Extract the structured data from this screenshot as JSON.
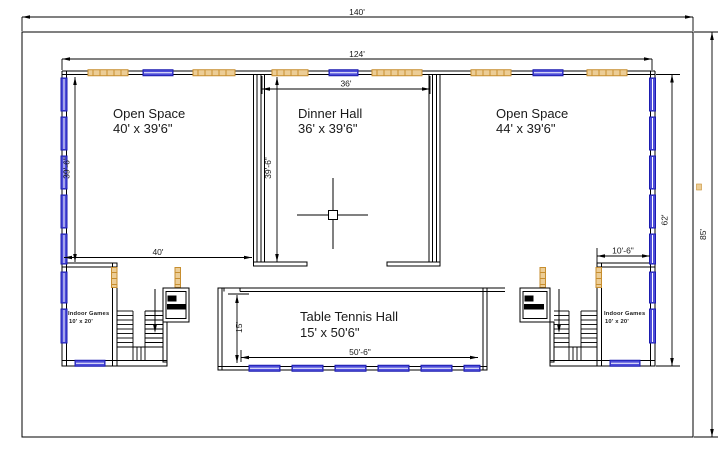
{
  "rooms": {
    "open_space_left": {
      "name": "Open Space",
      "size": "40' x 39'6\""
    },
    "dinner_hall": {
      "name": "Dinner Hall",
      "size": "36' x 39'6\""
    },
    "open_space_right": {
      "name": "Open Space",
      "size": "44' x 39'6\""
    },
    "table_tennis": {
      "name": "Table Tennis Hall",
      "size": "15' x 50'6\""
    },
    "indoor_games_left": {
      "name": "Indoor Games",
      "size": "10' x 20'"
    },
    "indoor_games_right": {
      "name": "Indoor Games",
      "size": "10' x 20'"
    }
  },
  "dimensions": {
    "overall_width": "140'",
    "inner_width": "124'",
    "dinner_width": "36'",
    "open_left_width": "40'",
    "open_left_height": "39'-6\"",
    "dinner_height": "39'-6\"",
    "inner_height": "62'",
    "overall_height": "85'",
    "tt_width": "50'-6\"",
    "tt_height": "15'",
    "indoor_right_width": "10'-6\""
  },
  "colors": {
    "window_blue": "#4d4dd9",
    "window_blue_stroke": "#1b1bb0",
    "door_tan": "#eccd96",
    "door_tan_stroke": "#c78e2f",
    "line": "#000000"
  }
}
